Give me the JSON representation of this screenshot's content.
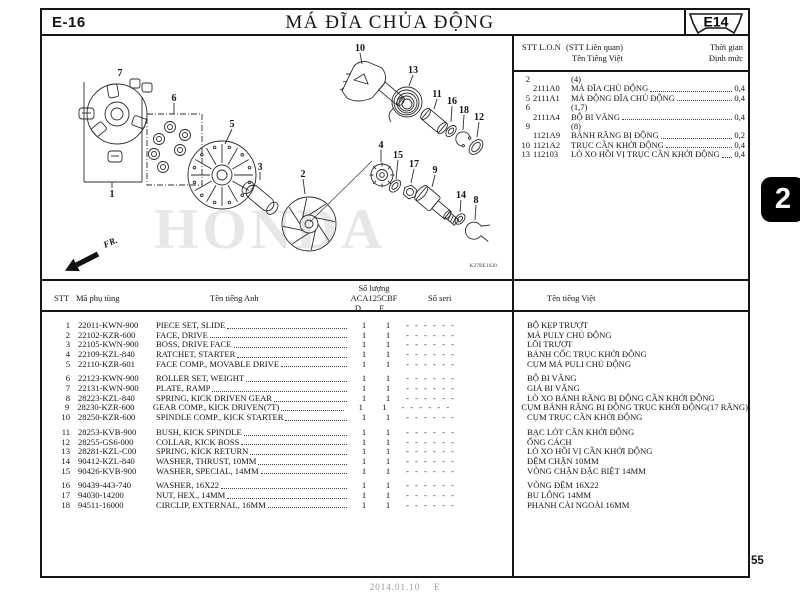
{
  "header": {
    "page_code": "E-16",
    "title": "MÁ ĐĨA CHỦA ĐỘNG",
    "ref_tag": "E14"
  },
  "side_tab": {
    "label": "2"
  },
  "related_table": {
    "headers": {
      "col_stt": "STT L.O.N",
      "col_rel": "(STT Liên quan)",
      "col_vi": "Tên Tiếng Việt",
      "col_time": "Thời gian",
      "col_quota": "Định mức"
    },
    "rows": [
      {
        "stt": "2",
        "code": "",
        "name": "(4)",
        "time": ""
      },
      {
        "stt": "",
        "code": "2111A0",
        "name": "MÁ ĐĨA CHỦ ĐỘNG",
        "time": "0,4"
      },
      {
        "stt": "5",
        "code": "2111A1",
        "name": "MÁ ĐỘNG ĐĨA CHỦ ĐỘNG",
        "time": "0,4"
      },
      {
        "stt": "6",
        "code": "",
        "name": "(1,7)",
        "time": ""
      },
      {
        "stt": "",
        "code": "2111A4",
        "name": "BỘ BI VĂNG",
        "time": "0,4"
      },
      {
        "stt": "9",
        "code": "",
        "name": "(8)",
        "time": ""
      },
      {
        "stt": "",
        "code": "1121A9",
        "name": "BÁNH RĂNG BỊ ĐỘNG",
        "time": "0,2"
      },
      {
        "stt": "10",
        "code": "1121A2",
        "name": "TRỤC CẦN KHỞI ĐỘNG",
        "time": "0,4"
      },
      {
        "stt": "13",
        "code": "112103",
        "name": "LÒ XO HỒI VỊ TRỤC CẦN KHỞI ĐỘNG",
        "time": "0,4"
      }
    ]
  },
  "diagram": {
    "callouts": {
      "c1": "1",
      "c2": "2",
      "c3": "3",
      "c4": "4",
      "c5": "5",
      "c6": "6",
      "c7": "7",
      "c8": "8",
      "c9": "9",
      "c10": "10",
      "c11": "11",
      "c12": "12",
      "c13": "13",
      "c14": "14",
      "c15": "15",
      "c16": "16",
      "c17": "17",
      "c18": "18"
    },
    "fr_label": "FR.",
    "watermark": "HONDA",
    "drawing_code": "K27BE1630"
  },
  "parts_table": {
    "headers": {
      "stt": "STT",
      "code": "Mã phụ tùng",
      "name_en": "Tên tiếng Anh",
      "qty1": "Số lượng",
      "qty2": "ACA125CBF",
      "d": "D",
      "e": "E",
      "seri": "Số seri",
      "name_vi": "Tên tiếng Việt"
    },
    "rows": [
      {
        "stt": "1",
        "code": "22011-KWN-900",
        "name_en": "PIECE SET, SLIDE",
        "d": "1",
        "e": "1",
        "seri": "- - - - - -",
        "name_vi": "BỘ KẸP TRƯỢT"
      },
      {
        "stt": "2",
        "code": "22102-KZR-600",
        "name_en": "FACE, DRIVE",
        "d": "1",
        "e": "1",
        "seri": "- - - - - -",
        "name_vi": "MÁ PULY CHỦ ĐỘNG"
      },
      {
        "stt": "3",
        "code": "22105-KWN-900",
        "name_en": "BOSS, DRIVE FACE",
        "d": "1",
        "e": "1",
        "seri": "- - - - - -",
        "name_vi": "LÕI TRƯỢT"
      },
      {
        "stt": "4",
        "code": "22109-KZL-840",
        "name_en": "RATCHET, STARTER",
        "d": "1",
        "e": "1",
        "seri": "- - - - - -",
        "name_vi": "BÁNH CỐC TRỤC KHỞI ĐỘNG"
      },
      {
        "stt": "5",
        "code": "22110-KZR-601",
        "name_en": "FACE COMP., MOVABLE DRIVE",
        "d": "1",
        "e": "1",
        "seri": "- - - - - -",
        "name_vi": "CỤM MÁ PULI CHỦ ĐỘNG"
      },
      {
        "stt": "6",
        "code": "22123-KWN-900",
        "name_en": "ROLLER SET, WEIGHT",
        "d": "1",
        "e": "1",
        "seri": "- - - - - -",
        "name_vi": "BỘ BI VĂNG"
      },
      {
        "stt": "7",
        "code": "22131-KWN-900",
        "name_en": "PLATE, RAMP",
        "d": "1",
        "e": "1",
        "seri": "- - - - - -",
        "name_vi": "GIÁ BI VĂNG"
      },
      {
        "stt": "8",
        "code": "28223-KZL-840",
        "name_en": "SPRING, KICK DRIVEN GEAR",
        "d": "1",
        "e": "1",
        "seri": "- - - - - -",
        "name_vi": "LÒ XO BÁNH RĂNG BỊ ĐỘNG CẦN KHỞI ĐỘNG"
      },
      {
        "stt": "9",
        "code": "28230-KZR-600",
        "name_en": "GEAR COMP., KICK DRIVEN(7T)",
        "d": "1",
        "e": "1",
        "seri": "- - - - - -",
        "name_vi": "CỤM BÁNH RĂNG BỊ ĐỘNG TRỤC KHỞI ĐỘNG(17 RĂNG)"
      },
      {
        "stt": "10",
        "code": "28250-KZR-600",
        "name_en": "SPINDLE COMP., KICK STARTER",
        "d": "1",
        "e": "1",
        "seri": "- - - - - -",
        "name_vi": "CỤM TRỤC CẦN KHỞI ĐỘNG"
      },
      {
        "stt": "11",
        "code": "28253-KVB-900",
        "name_en": "BUSH, KICK SPINDLE",
        "d": "1",
        "e": "1",
        "seri": "- - - - - -",
        "name_vi": "BẠC LÓT CẦN KHỞI ĐỘNG"
      },
      {
        "stt": "12",
        "code": "28255-GS6-000",
        "name_en": "COLLAR, KICK BOSS",
        "d": "1",
        "e": "1",
        "seri": "- - - - - -",
        "name_vi": "ỐNG CÁCH"
      },
      {
        "stt": "13",
        "code": "28281-KZL-C00",
        "name_en": "SPRING, KICK RETURN",
        "d": "1",
        "e": "1",
        "seri": "- - - - - -",
        "name_vi": "LÒ XO HỒI VỊ CẦN KHỞI ĐỘNG"
      },
      {
        "stt": "14",
        "code": "90412-KZL-840",
        "name_en": "WASHER, THRUST, 10MM",
        "d": "1",
        "e": "1",
        "seri": "- - - - - -",
        "name_vi": "ĐỆM CHẶN 10MM"
      },
      {
        "stt": "15",
        "code": "90426-KVB-900",
        "name_en": "WASHER, SPECIAL, 14MM",
        "d": "1",
        "e": "1",
        "seri": "- - - - - -",
        "name_vi": "VÒNG CHẶN ĐẶC BIỆT 14MM"
      },
      {
        "stt": "16",
        "code": "90439-443-740",
        "name_en": "WASHER, 16X22",
        "d": "1",
        "e": "1",
        "seri": "- - - - - -",
        "name_vi": "VÒNG ĐỆM 16X22"
      },
      {
        "stt": "17",
        "code": "94030-14200",
        "name_en": "NUT, HEX., 14MM",
        "d": "1",
        "e": "1",
        "seri": "- - - - - -",
        "name_vi": "BU LÔNG 14MM"
      },
      {
        "stt": "18",
        "code": "94511-16000",
        "name_en": "CIRCLIP, EXTERNAL, 16MM",
        "d": "1",
        "e": "1",
        "seri": "- - - - - -",
        "name_vi": "PHANH CÀI NGOÀI 16MM"
      }
    ]
  },
  "footer": {
    "date": "2014.01.10",
    "rev": "E",
    "page": "55"
  }
}
